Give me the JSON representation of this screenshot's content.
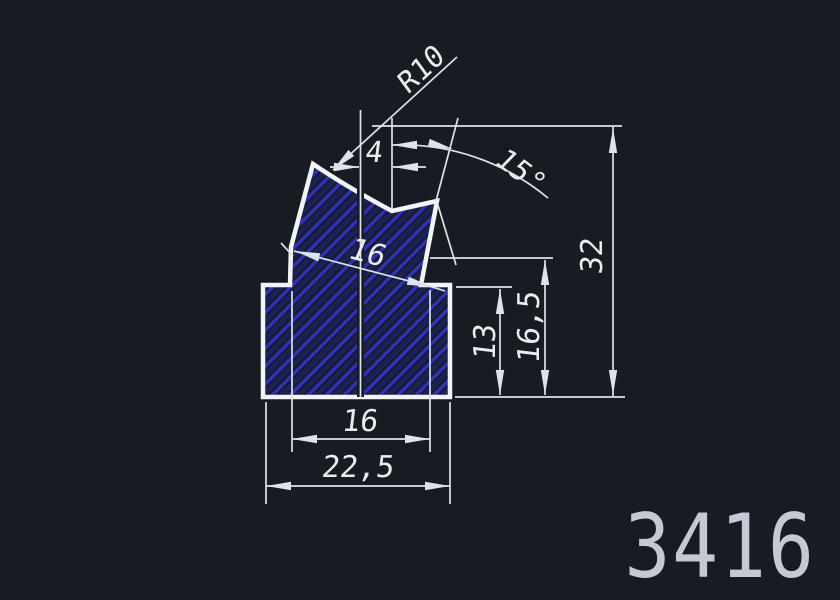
{
  "drawing": {
    "title": "profile-cross-section",
    "part_number": "3416",
    "colors": {
      "background": "#171b22",
      "outline": "#f2f5f8",
      "thin_line": "#dde3e8",
      "dim_text": "#e9edf2",
      "hatch_bright": "#2d31bd",
      "hatch_faint": "#1e2157",
      "part_number_text": "#c3cad3"
    },
    "profile": {
      "path": "M 263,285 L 290,285 L 291,247 L 313,164 Q 347,187 392,211 L 437,201 L 421,285 L 450,285 L 450,397 L 263,397 Z",
      "outline_width": 4.5,
      "centerline": [
        360.5,
        110,
        360.5,
        397
      ]
    },
    "hatch": {
      "spacing": 12.7,
      "bright_width": 3.6,
      "faint_width": 5,
      "angle": -45
    },
    "dims": [
      {
        "id": "radius-r10",
        "label": "R10",
        "lines": [
          [
            457,
            57,
            333,
            170
          ]
        ],
        "arrows": [
          [
            333,
            170,
            137
          ]
        ],
        "text": {
          "x": 427,
          "y": 77,
          "rot": -43,
          "size": 29
        }
      },
      {
        "id": "offset-4",
        "label": "4",
        "lines": [
          [
            392,
            118,
            392,
            209
          ],
          [
            330,
            167,
            359,
            167
          ],
          [
            393,
            167,
            426,
            167
          ]
        ],
        "arrows": [
          [
            359,
            167,
            0
          ],
          [
            393,
            167,
            180
          ]
        ],
        "text": {
          "x": 373,
          "y": 162,
          "rot": 0,
          "size": 29
        }
      },
      {
        "id": "angle-15",
        "label": "15°",
        "lines": [
          [
            458,
            118,
            436,
            201
          ],
          [
            437,
            202,
            456,
            265
          ]
        ],
        "arcs": [
          [
            392,
            145,
            548,
            198,
            230
          ]
        ],
        "arrows": [
          [
            392,
            145,
            180
          ],
          [
            453,
            149,
            14
          ]
        ],
        "text": {
          "x": 514,
          "y": 178,
          "rot": 37,
          "size": 29
        }
      },
      {
        "id": "width-16-aligned",
        "label": "16",
        "lines": [
          [
            294,
            251,
            432,
            287
          ],
          [
            432,
            287,
            445,
            291
          ],
          [
            281,
            243,
            293,
            256
          ]
        ],
        "arrows": [
          [
            295,
            251,
            194.6
          ],
          [
            432,
            287,
            14.6
          ]
        ],
        "text": {
          "x": 364,
          "y": 262,
          "rot": 15,
          "size": 30
        }
      },
      {
        "id": "height-32",
        "label": "32",
        "lines": [
          [
            372,
            126,
            622,
            126
          ],
          [
            455,
            397,
            625,
            397
          ],
          [
            613,
            127,
            613,
            396
          ]
        ],
        "arrows": [
          [
            613,
            128,
            -90
          ],
          [
            613,
            395,
            90
          ]
        ],
        "text": {
          "x": 602,
          "y": 257,
          "rot": -90,
          "size": 30
        }
      },
      {
        "id": "height-16-5",
        "label": "16,5",
        "lines": [
          [
            430,
            258,
            553,
            258
          ],
          [
            545,
            260,
            545,
            395
          ]
        ],
        "arrows": [
          [
            545,
            260,
            -90
          ],
          [
            545,
            395,
            90
          ]
        ],
        "text": {
          "x": 539,
          "y": 328,
          "rot": -90,
          "size": 30
        }
      },
      {
        "id": "height-13",
        "label": "13",
        "lines": [
          [
            456,
            287,
            512,
            287
          ],
          [
            500,
            289,
            500,
            395
          ]
        ],
        "arrows": [
          [
            500,
            289,
            -90
          ],
          [
            500,
            395,
            90
          ]
        ],
        "text": {
          "x": 495,
          "y": 343,
          "rot": -90,
          "size": 30
        }
      },
      {
        "id": "width-16-bottom",
        "label": "16",
        "lines": [
          [
            292,
            291,
            292,
            452
          ],
          [
            430,
            290,
            430,
            452
          ],
          [
            292,
            439,
            430,
            439
          ]
        ],
        "arrows": [
          [
            292,
            439,
            180
          ],
          [
            430,
            439,
            0
          ]
        ],
        "text": {
          "x": 359,
          "y": 431,
          "rot": 0,
          "size": 30
        }
      },
      {
        "id": "width-22-5",
        "label": "22,5",
        "lines": [
          [
            266,
            402,
            266,
            504
          ],
          [
            450,
            402,
            450,
            504
          ],
          [
            266,
            486,
            450,
            486
          ]
        ],
        "arrows": [
          [
            266,
            486,
            180
          ],
          [
            450,
            486,
            0
          ]
        ],
        "text": {
          "x": 357,
          "y": 477,
          "rot": 0,
          "size": 30
        }
      }
    ],
    "part_number_pos": {
      "x": 720,
      "y": 577,
      "size": 88,
      "scale_x": 0.87
    }
  }
}
